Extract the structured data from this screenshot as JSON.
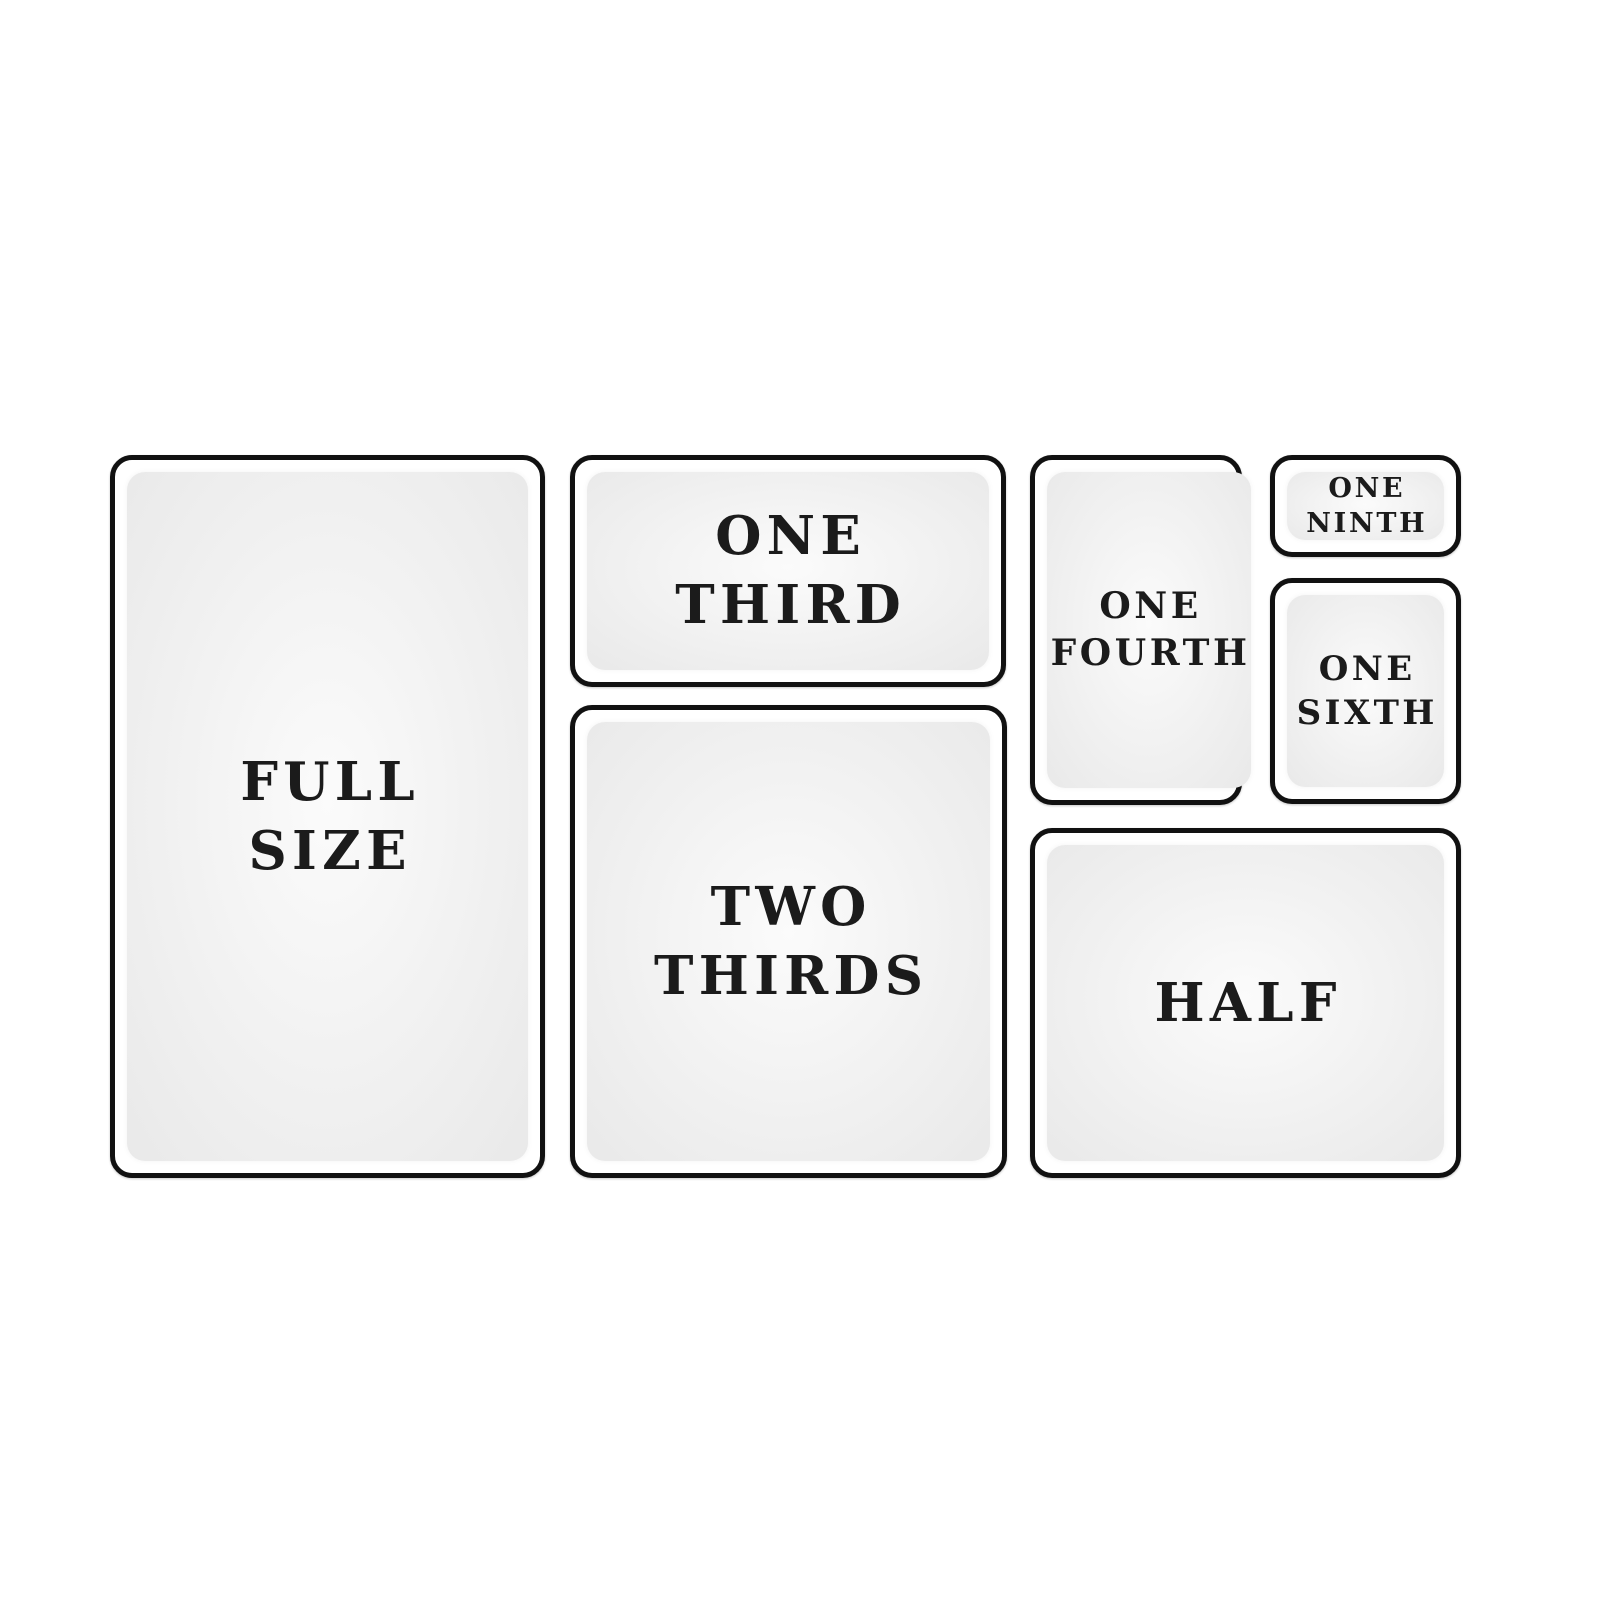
{
  "styles": {
    "background": "#ffffff",
    "border_color": "#111111",
    "text_color": "#1b1b1b",
    "pan_fill_center": "#fbfbfb",
    "pan_fill_edge": "#e9e9e9"
  },
  "diagram": {
    "description": "pan-size-layout-diagram",
    "panels": [
      {
        "id": "full-size",
        "lines": [
          "FULL",
          "SIZE"
        ],
        "x": 110,
        "y": 455,
        "w": 435,
        "h": 723,
        "font": 53
      },
      {
        "id": "one-third",
        "lines": [
          "ONE",
          "THIRD"
        ],
        "x": 570,
        "y": 455,
        "w": 436,
        "h": 232,
        "font": 53
      },
      {
        "id": "two-thirds",
        "lines": [
          "TWO",
          "THIRDS"
        ],
        "x": 570,
        "y": 705,
        "w": 437,
        "h": 473,
        "font": 53
      },
      {
        "id": "one-fourth",
        "lines": [
          "ONE",
          "FOURTH"
        ],
        "x": 1030,
        "y": 455,
        "w": 212,
        "h": 350,
        "font": 36
      },
      {
        "id": "one-ninth",
        "lines": [
          "ONE",
          "NINTH"
        ],
        "x": 1270,
        "y": 455,
        "w": 191,
        "h": 102,
        "font": 27
      },
      {
        "id": "one-sixth",
        "lines": [
          "ONE",
          "SIXTH"
        ],
        "x": 1270,
        "y": 578,
        "w": 191,
        "h": 226,
        "font": 34
      },
      {
        "id": "half",
        "lines": [
          "HALF"
        ],
        "x": 1030,
        "y": 828,
        "w": 431,
        "h": 350,
        "font": 53
      }
    ]
  }
}
